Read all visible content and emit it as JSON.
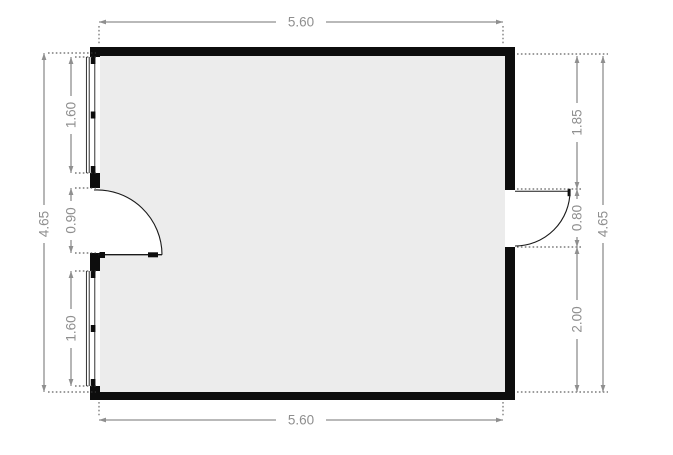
{
  "floorplan": {
    "dimension_labels": {
      "top_width": "5.60",
      "bottom_width": "5.60",
      "left_height": "4.65",
      "right_height": "4.65"
    },
    "left_segments": [
      {
        "label": "1.60",
        "feature": "window"
      },
      {
        "label": "0.90",
        "feature": "door-opening"
      },
      {
        "label": "1.60",
        "feature": "window"
      }
    ],
    "right_segments": [
      {
        "label": "1.85",
        "feature": "wall-section"
      },
      {
        "label": "0.80",
        "feature": "door-opening"
      },
      {
        "label": "2.00",
        "feature": "wall-section"
      }
    ],
    "features": {
      "windows_on_left_wall": 2,
      "left_door_swing": "inward",
      "right_door_swing": "outward"
    },
    "colors": {
      "wall": "#0d0d0d",
      "floor": "#ececec",
      "dimension_line": "#8f8f8f",
      "dimension_text": "#8f8f8f",
      "extension_dots": "#3a3a3a",
      "background": "#ffffff"
    }
  }
}
